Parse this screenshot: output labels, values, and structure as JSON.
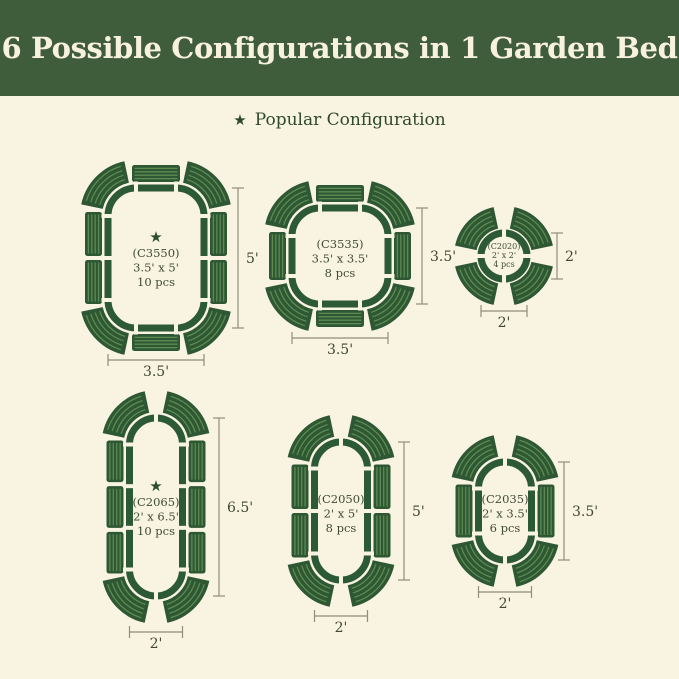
{
  "background_color": "#F9F3E2",
  "header": {
    "title": "6 Possible Configurations in 1 Garden Bed",
    "bg_color": "#3F5D3B",
    "text_color": "#F7F1DE"
  },
  "legend": {
    "star_icon": "★",
    "label": "Popular Configuration",
    "color": "#2E4A2C"
  },
  "colors": {
    "outline": "#2D5A36",
    "panel": "#2E5733",
    "panel_stripe": "#5D8B52",
    "dim_line": "#908D7B",
    "dim_text": "#3F4736",
    "label_text": "#3E4B37",
    "star": "#2B4F2E"
  },
  "configs": [
    {
      "id": "C3550",
      "code": "(C3550)",
      "size": "3.5' x 5'",
      "pieces": "10 pcs",
      "popular": true,
      "dim_height": "5'",
      "dim_width": "3.5'"
    },
    {
      "id": "C3535",
      "code": "(C3535)",
      "size": "3.5' x 3.5'",
      "pieces": "8 pcs",
      "popular": false,
      "dim_height": "3.5'",
      "dim_width": "3.5'"
    },
    {
      "id": "C2020",
      "code": "(C2020)",
      "size": "2' x 2'",
      "pieces": "4 pcs",
      "popular": false,
      "dim_height": "2'",
      "dim_width": "2'"
    },
    {
      "id": "C2065",
      "code": "(C2065)",
      "size": "2' x 6.5'",
      "pieces": "10 pcs",
      "popular": true,
      "dim_height": "6.5'",
      "dim_width": "2'"
    },
    {
      "id": "C2050",
      "code": "(C2050)",
      "size": "2' x 5'",
      "pieces": "8 pcs",
      "popular": false,
      "dim_height": "5'",
      "dim_width": "2'"
    },
    {
      "id": "C2035",
      "code": "(C2035)",
      "size": "2' x 3.5'",
      "pieces": "6 pcs",
      "popular": false,
      "dim_height": "3.5'",
      "dim_width": "2'"
    }
  ]
}
